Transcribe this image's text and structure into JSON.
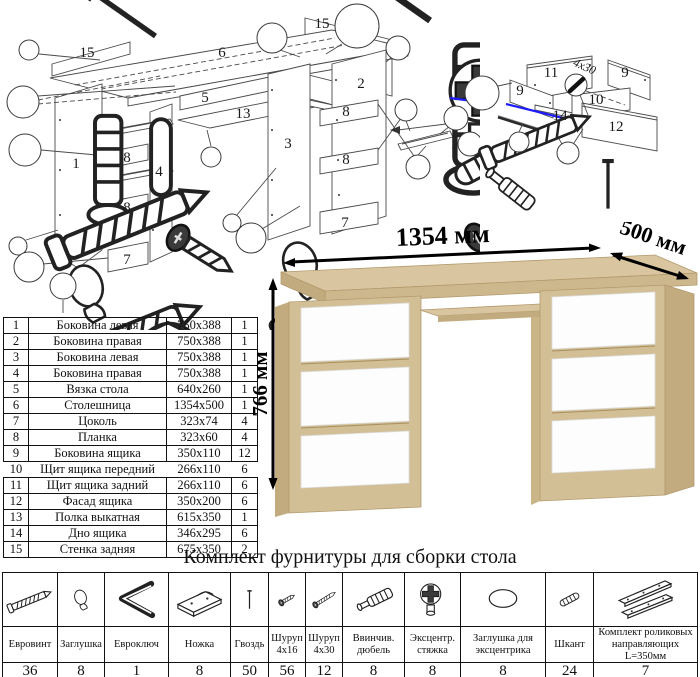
{
  "parts_table": {
    "rows": [
      {
        "num": "1",
        "name": "Боковина левая",
        "size": "750х388",
        "qty": "1"
      },
      {
        "num": "2",
        "name": "Боковина правая",
        "size": "750х388",
        "qty": "1"
      },
      {
        "num": "3",
        "name": "Боковина левая",
        "size": "750х388",
        "qty": "1"
      },
      {
        "num": "4",
        "name": "Боковина правая",
        "size": "750х388",
        "qty": "1"
      },
      {
        "num": "5",
        "name": "Вязка стола",
        "size": "640х260",
        "qty": "1"
      },
      {
        "num": "6",
        "name": "Столешница",
        "size": "1354х500",
        "qty": "1"
      },
      {
        "num": "7",
        "name": "Цоколь",
        "size": "323х74",
        "qty": "4"
      },
      {
        "num": "8",
        "name": "Планка",
        "size": "323х60",
        "qty": "4"
      },
      {
        "num": "9",
        "name": "Боковина ящика",
        "size": "350х110",
        "qty": "12"
      },
      {
        "num": "10",
        "name": "Щит ящика передний",
        "size": "266х110",
        "qty": "6"
      },
      {
        "num": "11",
        "name": "Щит ящика задний",
        "size": "266х110",
        "qty": "6"
      },
      {
        "num": "12",
        "name": "Фасад ящика",
        "size": "350х200",
        "qty": "6"
      },
      {
        "num": "13",
        "name": "Полка выкатная",
        "size": "615х350",
        "qty": "1"
      },
      {
        "num": "14",
        "name": "Дно ящика",
        "size": "346х295",
        "qty": "6"
      },
      {
        "num": "15",
        "name": "Стенка задняя",
        "size": "675х350",
        "qty": "2"
      }
    ]
  },
  "desk": {
    "dims": {
      "width": "1354 мм",
      "depth": "500 мм",
      "height": "766 мм"
    }
  },
  "hardware": {
    "title": "Комплект фурнитуры для сборки стола",
    "items": [
      {
        "name": "Евровинт",
        "qty": "36",
        "icon": "confirmat-screw-icon"
      },
      {
        "name": "Заглушка",
        "qty": "8",
        "icon": "cap-icon"
      },
      {
        "name": "Евроключ",
        "qty": "1",
        "icon": "hex-key-icon"
      },
      {
        "name": "Ножка",
        "qty": "8",
        "icon": "foot-icon"
      },
      {
        "name": "Гвоздь",
        "qty": "50",
        "icon": "nail-icon"
      },
      {
        "name": "Шуруп 4х16",
        "qty": "56",
        "icon": "screw-short-icon"
      },
      {
        "name": "Шуруп 4х30",
        "qty": "12",
        "icon": "screw-long-icon"
      },
      {
        "name": "Ввинчив. дюбель",
        "qty": "8",
        "icon": "dowel-bolt-icon"
      },
      {
        "name": "Эксцентр. стяжка",
        "qty": "8",
        "icon": "cam-lock-icon"
      },
      {
        "name": "Заглушка для эксцентрика",
        "qty": "8",
        "icon": "cam-cover-icon"
      },
      {
        "name": "Шкант",
        "qty": "24",
        "icon": "wood-dowel-icon"
      },
      {
        "name": "Комплект роликовых направляющих L=350мм",
        "qty": "7",
        "icon": "drawer-slides-icon"
      }
    ]
  },
  "diagram": {
    "main_labels": [
      {
        "t": "15",
        "x": 87,
        "y": 57
      },
      {
        "t": "6",
        "x": 222,
        "y": 57
      },
      {
        "t": "15",
        "x": 322,
        "y": 28
      },
      {
        "t": "2",
        "x": 361,
        "y": 88
      },
      {
        "t": "5",
        "x": 205,
        "y": 102
      },
      {
        "t": "13",
        "x": 243,
        "y": 118
      },
      {
        "t": "1",
        "x": 76,
        "y": 168
      },
      {
        "t": "8",
        "x": 127,
        "y": 162
      },
      {
        "t": "4",
        "x": 159,
        "y": 176
      },
      {
        "t": "8",
        "x": 127,
        "y": 212
      },
      {
        "t": "7",
        "x": 127,
        "y": 264
      },
      {
        "t": "3",
        "x": 288,
        "y": 148
      },
      {
        "t": "8",
        "x": 346,
        "y": 116
      },
      {
        "t": "8",
        "x": 346,
        "y": 164
      },
      {
        "t": "7",
        "x": 345,
        "y": 227
      }
    ],
    "drawer_labels": [
      {
        "t": "11",
        "x": 111,
        "y": 52
      },
      {
        "t": "9",
        "x": 185,
        "y": 52
      },
      {
        "t": "9",
        "x": 80,
        "y": 70
      },
      {
        "t": "10",
        "x": 156,
        "y": 79
      },
      {
        "t": "14",
        "x": 120,
        "y": 95
      },
      {
        "t": "12",
        "x": 176,
        "y": 106
      },
      {
        "t": "4х30",
        "x": 143,
        "y": 45,
        "rot": 24,
        "small": true
      }
    ]
  },
  "colors": {
    "wood": "#d3bf96",
    "wood_dark": "#c2ab7e",
    "highlight_blue": "#1c1cff"
  }
}
